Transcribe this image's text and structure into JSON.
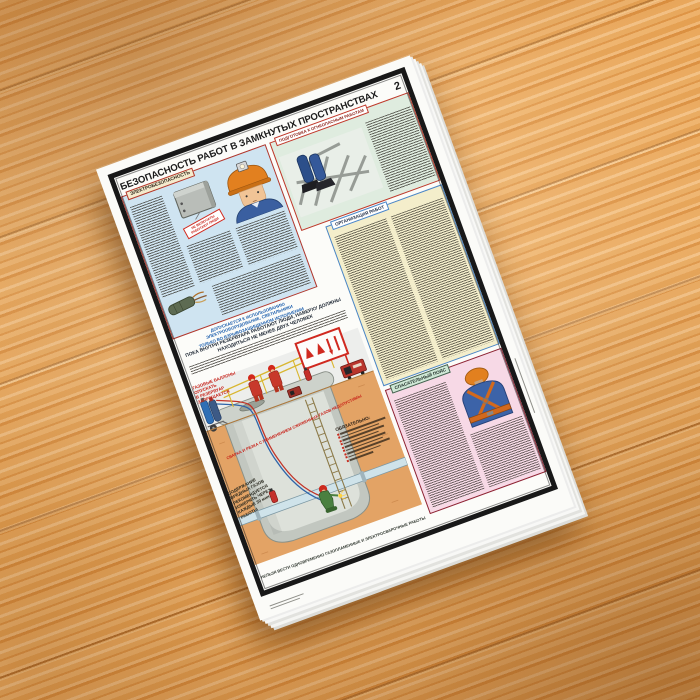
{
  "scene": {
    "background": "wooden table surface",
    "object": "stack of printed safety posters"
  },
  "poster": {
    "page_number": "2",
    "title": "БЕЗОПАСНОСТЬ РАБОТ В ЗАМКНУТЫХ ПРОСТРАНСТВАХ",
    "sections": {
      "electrical": {
        "label": "ЭЛЕКТРОБЕЗОПАСНОСТЬ",
        "warning_tag": {
          "line1": "НЕ ВКЛЮЧАТЬ!",
          "line2": "РАБОТАЮТ ЛЮДИ"
        }
      },
      "preparation": {
        "label": "ПОДГОТОВКА К ОГНЕОПАСНЫМ РАБОТАМ"
      },
      "organization": {
        "label": "ОРГАНИЗАЦИЯ РАБОТ"
      },
      "rescue_belt": {
        "label": "СПАСАТЕЛЬНЫЙ ПОЯС"
      }
    },
    "notices": {
      "explosionproof": [
        "ДОПУСКАЕТСЯ К ИСПОЛЬЗОВАНИЮ",
        "ЭЛЕКТРООБОРУДОВАНИЕ, СВЕТИЛЬНИКИ",
        "ТОЛЬКО ВО ВЗРЫВОЗАЩИЩЕННОМ ИСПОЛНЕНИИ"
      ],
      "two_people": "ПОКА ВНУТРИ РЕЗЕРВУАРА РАБОТАЮТ ЛЮДИ, НАВЕРХУ ДОЛЖНЫ НАХОДИТЬСЯ НЕ МЕНЕЕ ДВУХ ЧЕЛОВЕК",
      "gas_cylinders": [
        "ГАЗОВЫЕ БАЛЛОНЫ",
        "ОПУСКАТЬ",
        "В РЕЗЕРВУАР",
        "ЗАПРЕЩАЕТСЯ"
      ],
      "lpg_welding": "СВАРКА И РЕЗКА С ПРИМЕНЕНИЕМ СЖИЖЕННЫХ ГАЗОВ НЕДОПУСТИМЫ",
      "gas_check": [
        "СОДЕРЖАНИЕ",
        "ВРЕДНЫХ ГАЗОВ",
        "РЕКОМЕНДУЕТСЯ",
        "ИЗМЕРЯТЬ ЧЕРЕЗ",
        "КАЖДЫЕ 30 мин",
        "РАБОТЫ"
      ],
      "mandatory": "ОБЯЗАТЕЛЬНО:",
      "no_simultaneous": "НЕЛЬЗЯ ВЕСТИ ОДНОВРЕМЕННО ГАЗОПЛАМЕННЫЕ И ЭЛЕКТРОСВАРОЧНЫЕ РАБОТЫ"
    },
    "colors": {
      "wood": "#e8a65c",
      "frame": "#1a1a1a",
      "alert_red": "#cf2a20",
      "notice_blue": "#1d5fae",
      "electrical_bg": "#cfe4f1",
      "preparation_bg": "#dfecdf",
      "organization_bg": "#f4eecb",
      "rescue_bg": "#f7d9e6",
      "earth": "#e3a365"
    },
    "illustrations": [
      "switch-box-icon",
      "miner-with-headlamp-icon",
      "cable-icon",
      "worker-legs-in-tank-icon",
      "gas-cylinder-trolley-icon",
      "workers-on-reservoir-icon",
      "fire-safety-board-icon",
      "generator-icon",
      "reservoir-cross-section-icon",
      "welder-in-tank-icon",
      "rescue-belt-harness-icon"
    ]
  }
}
